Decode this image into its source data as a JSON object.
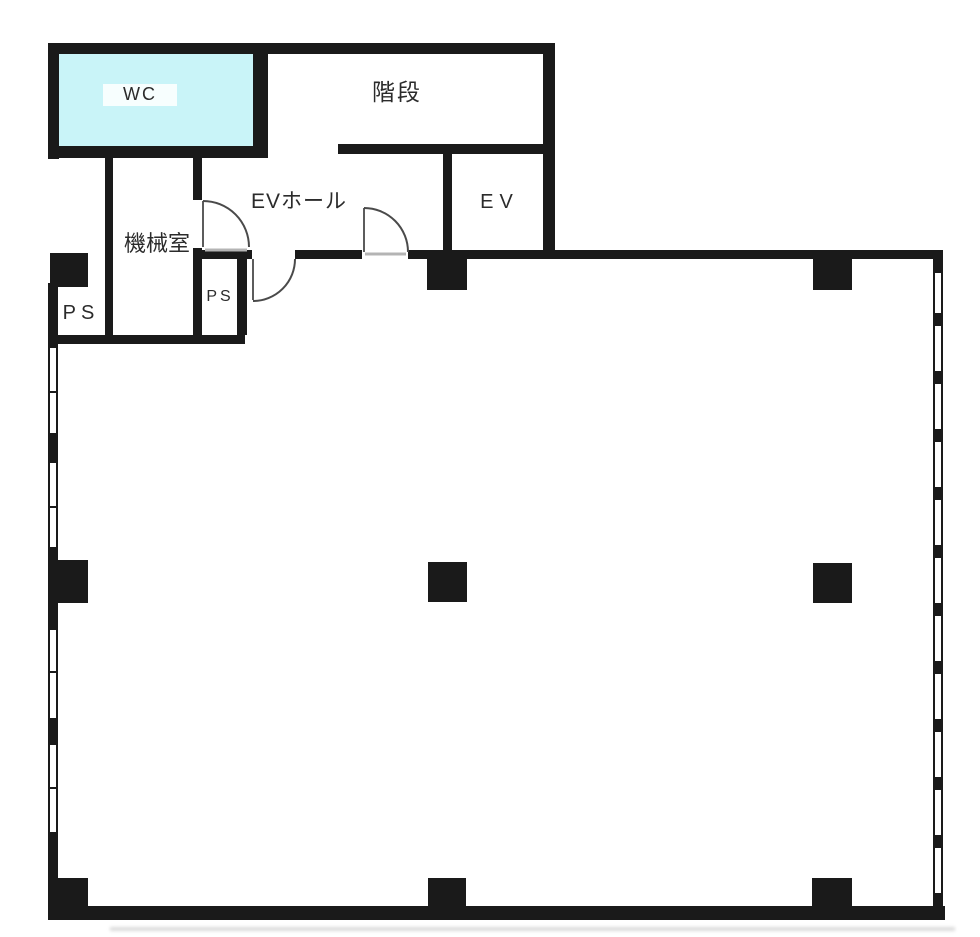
{
  "rooms": {
    "wc": {
      "label": "WC"
    },
    "stairs": {
      "label": "階段"
    },
    "ev_hall": {
      "label": "EVホール"
    },
    "elevator": {
      "label": "EV"
    },
    "machine_room": {
      "label": "機械室"
    },
    "pipe_space_left": {
      "label": "PS"
    },
    "pipe_space_center": {
      "label": "PS"
    }
  },
  "colors": {
    "wall": "#1a1a1a",
    "wc_fill": "#c9f4f8",
    "door_line": "#4a4a4a",
    "threshold": "#b4b4b4",
    "text": "#2b2b2b",
    "background": "#ffffff"
  }
}
